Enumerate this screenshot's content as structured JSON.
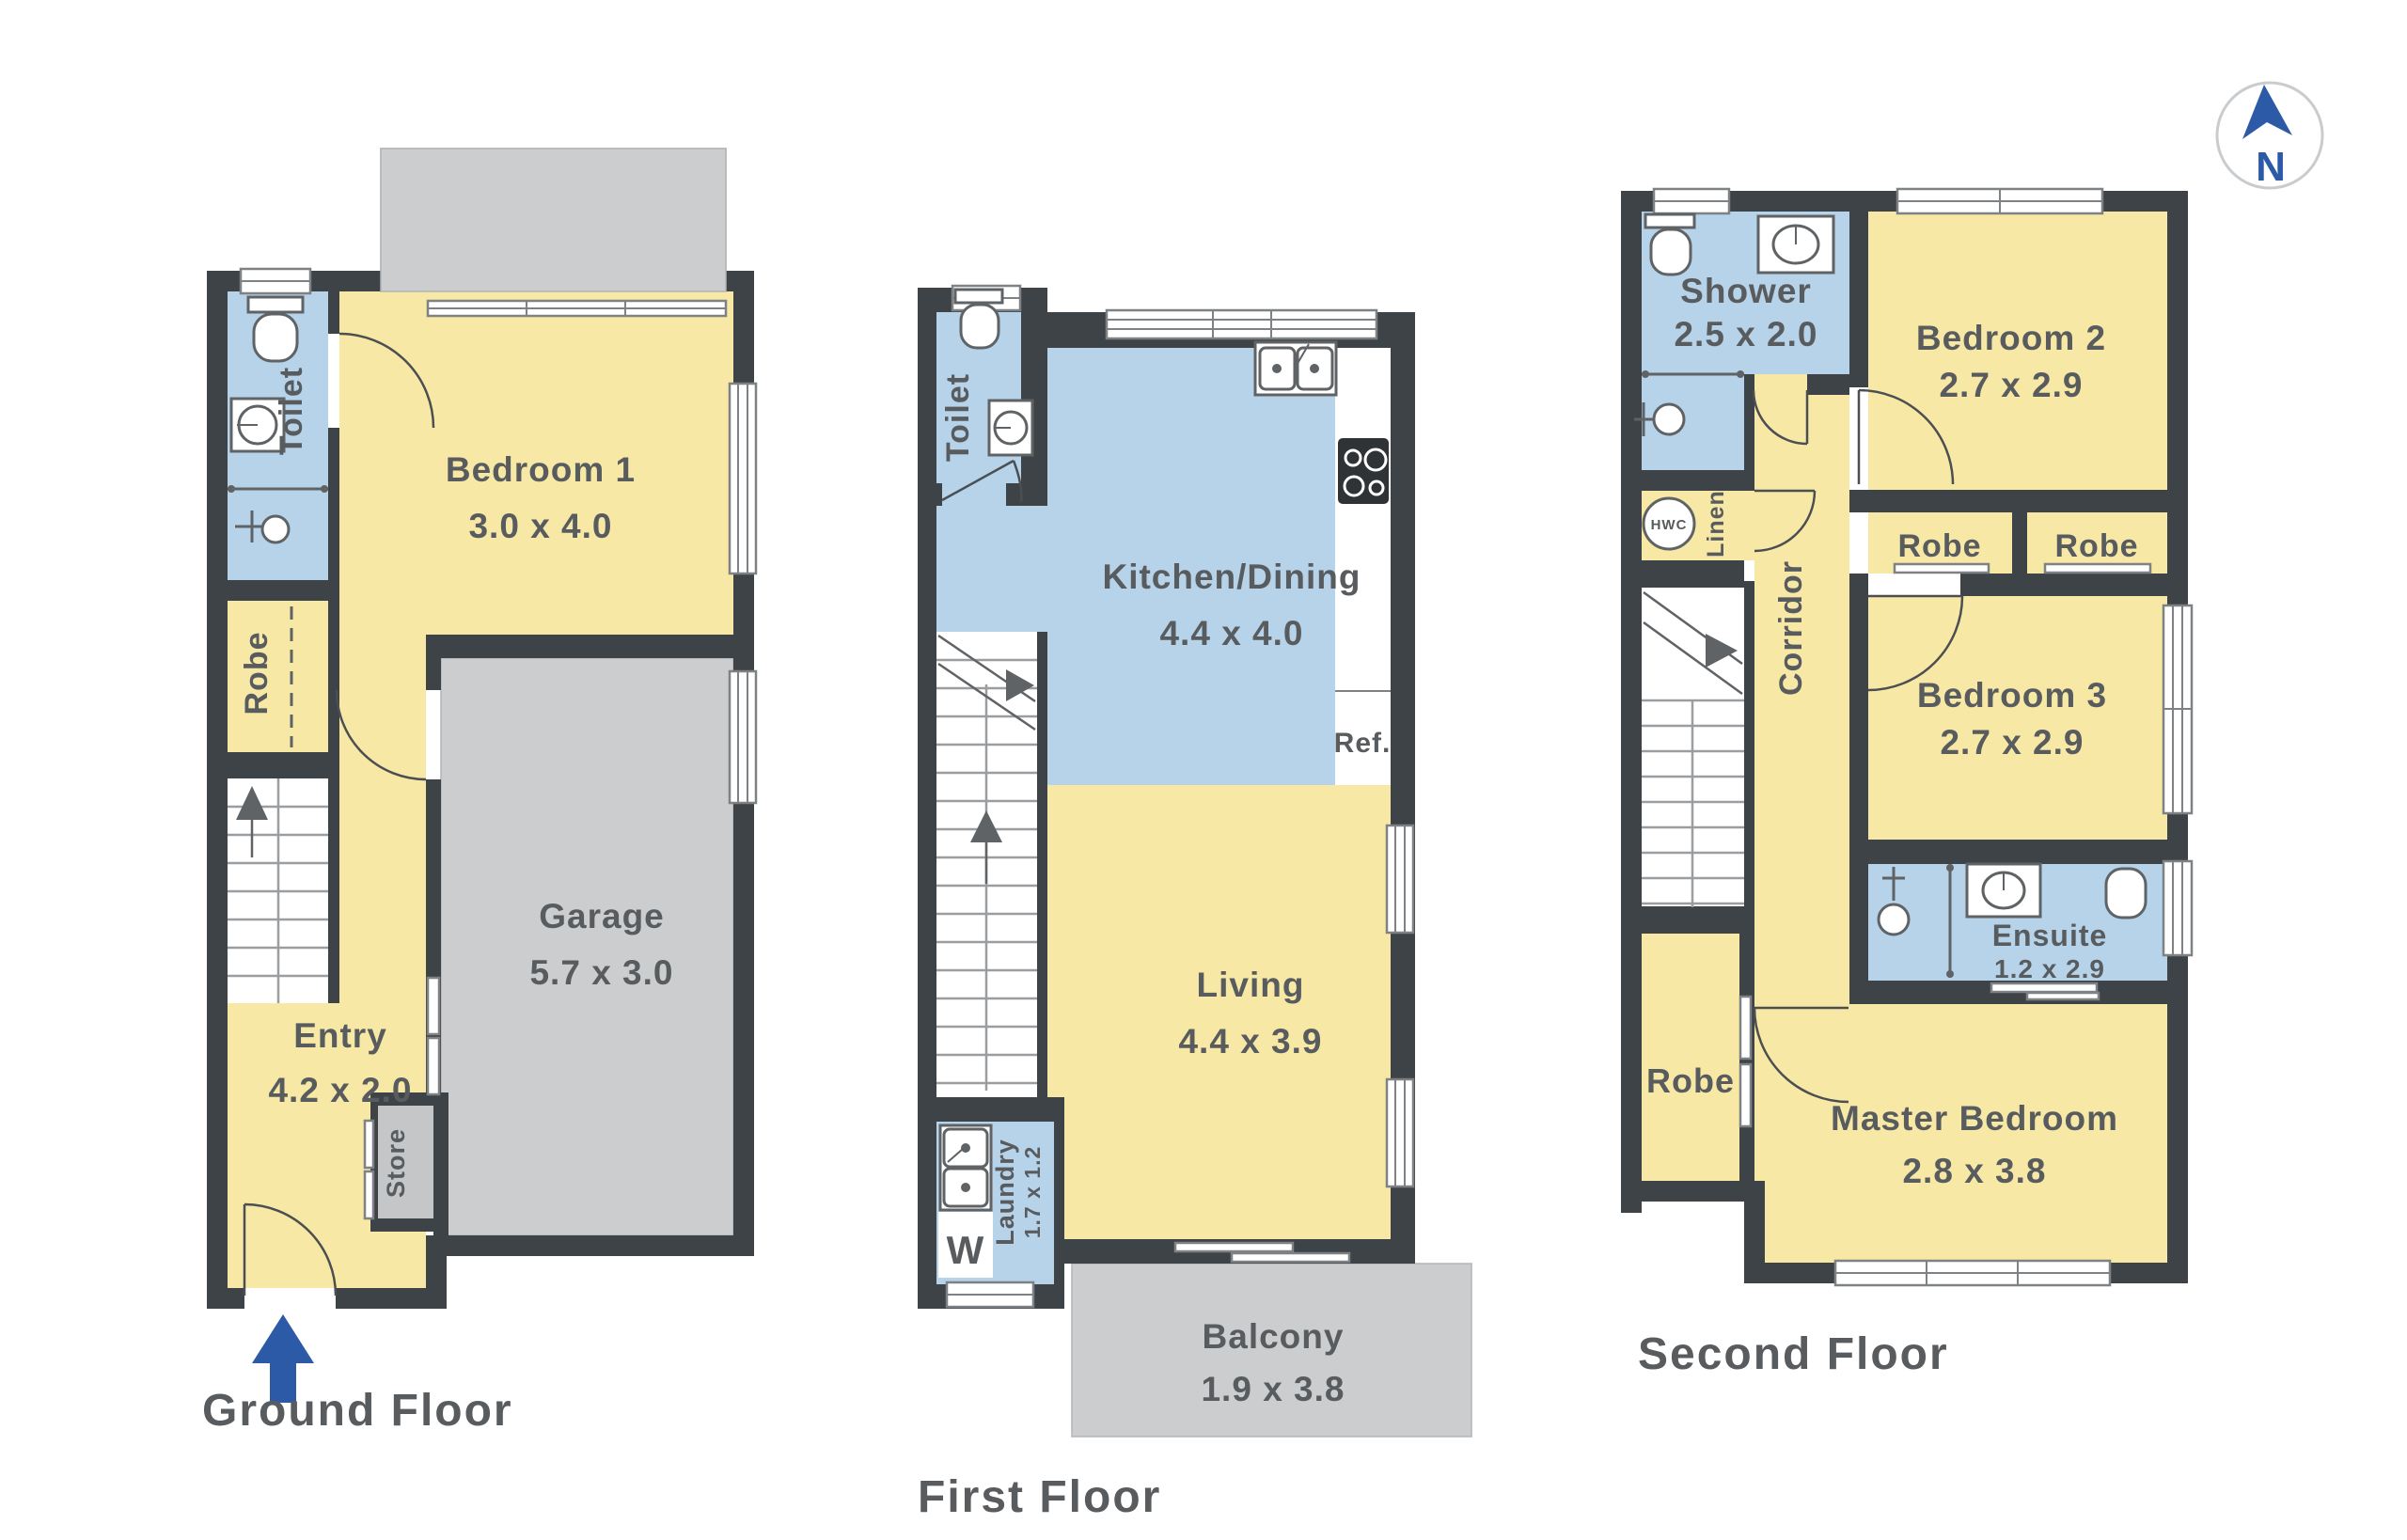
{
  "theme": {
    "wall": "#3e4347",
    "room_yellow": "#f8e8a5",
    "room_blue": "#b6d3e9",
    "area_gray": "#cbcdce",
    "area_edge": "#b2b4b6",
    "store_gray": "#c4c6c8",
    "text": "#595c5f",
    "fixture": "#5f6365",
    "tread": "#9b9ea0",
    "door": "#4b4f52",
    "winline": "#7f8284",
    "accent_blue": "#2c5aa6"
  },
  "compass": {
    "label": "N"
  },
  "ground": {
    "title": "Ground Floor",
    "toilet": "Toilet",
    "bedroom1": "Bedroom 1",
    "bedroom1_dims": "3.0 x 4.0",
    "robe": "Robe",
    "garage": "Garage",
    "garage_dims": "5.7 x 3.0",
    "entry": "Entry",
    "entry_dims": "4.2 x 2.0",
    "store": "Store"
  },
  "first": {
    "title": "First Floor",
    "toilet": "Toilet",
    "kitchen": "Kitchen/Dining",
    "kitchen_dims": "4.4 x 4.0",
    "ref": "Ref.",
    "living": "Living",
    "living_dims": "4.4 x 3.9",
    "laundry": "Laundry",
    "laundry_dims": "1.7 x 1.2",
    "washer": "W",
    "balcony": "Balcony",
    "balcony_dims": "1.9 x 3.8"
  },
  "second": {
    "title": "Second Floor",
    "shower": "Shower",
    "shower_dims": "2.5 x 2.0",
    "bedroom2": "Bedroom 2",
    "bedroom2_dims": "2.7 x 2.9",
    "hwc": "HWC",
    "linen": "Linen",
    "corridor": "Corridor",
    "robe_bed2": "Robe",
    "robe_bed3": "Robe",
    "bedroom3": "Bedroom 3",
    "bedroom3_dims": "2.7 x 2.9",
    "ensuite": "Ensuite",
    "ensuite_dims": "1.2 x 2.9",
    "robe_master": "Robe",
    "master": "Master Bedroom",
    "master_dims": "2.8 x 3.8"
  }
}
